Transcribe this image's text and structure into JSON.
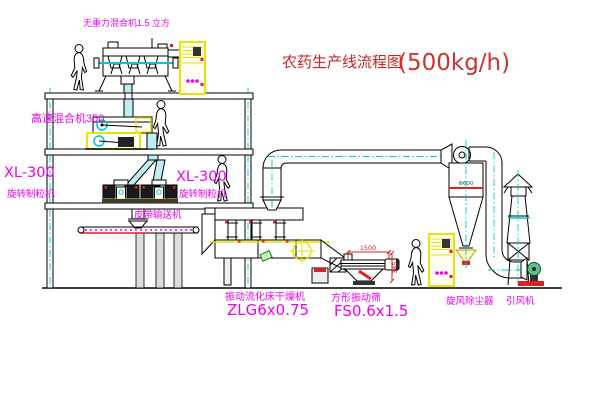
{
  "title": {
    "name": "农药生产线流程图",
    "capacity": "(500kg/h)"
  },
  "labels": {
    "top_mixer": "无重力混合机1.5 立方",
    "hs_mixer": "高速混合机350",
    "xl_left_model": "XL-300",
    "xl_left_name": "旋转制粒机",
    "xl_right_model": "XL-300",
    "xl_right_name": "旋转制粒机",
    "conveyor": "皮带输送机",
    "dryer_name": "振动流化床干燥机",
    "dryer_model": "ZLG6x0.75",
    "sieve_name": "方形振动筛",
    "sieve_model": "FS0.6x1.5",
    "cyclone": "旋风除尘器",
    "fan": "引风机"
  },
  "dimensions": {
    "sieve_length": "1500",
    "sieve_height": "345",
    "cyclone_diameter": "Φ600"
  },
  "colors": {
    "label_magenta": "#ee00ee",
    "title_red": "#cc2222",
    "dimension_red": "#dd2222",
    "centerline_cyan": "#00c8c8",
    "highlight_yellow": "#e6e600"
  }
}
